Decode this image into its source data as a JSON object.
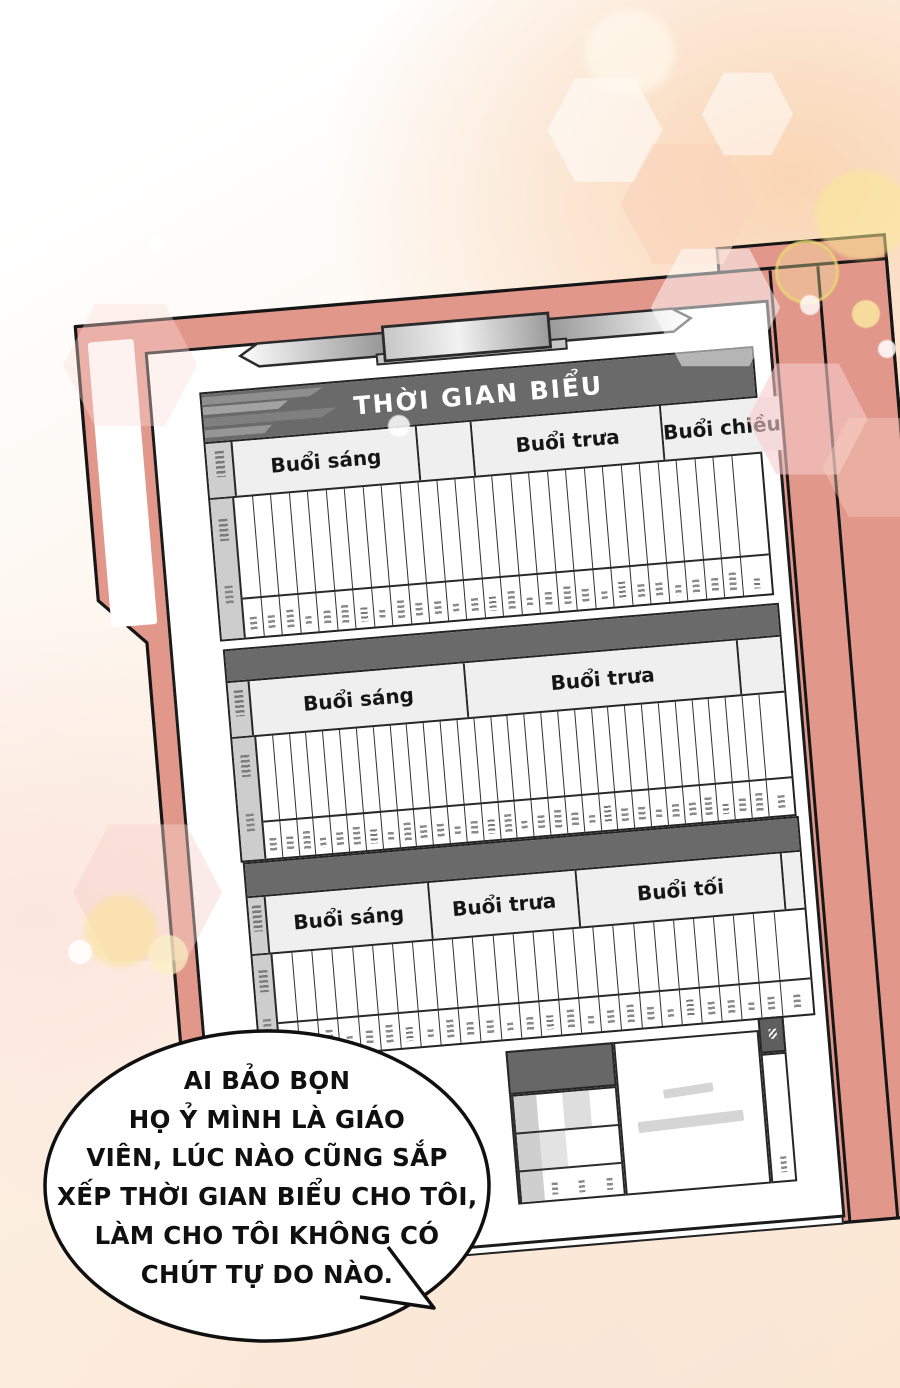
{
  "comic": {
    "paper": {
      "title": "THỜI GIAN BIỂU",
      "tables": [
        {
          "sessions": [
            "Buổi sáng",
            "Buổi trưa",
            "Buổi chiều"
          ],
          "column_count": 28
        },
        {
          "sessions": [
            "Buổi sáng",
            "Buổi trưa"
          ],
          "column_count": 31
        },
        {
          "sessions": [
            "Buổi sáng",
            "Buổi trưa",
            "Buổi tối"
          ],
          "column_count": 26
        }
      ]
    },
    "speech_bubble": {
      "lines": [
        "AI BẢO BỌN",
        "HỌ Ỷ MÌNH LÀ GIÁO",
        "VIÊN, LÚC NÀO CŨNG SẮP",
        "XẾP THỜI GIAN BIỂU CHO TÔI,",
        "LÀM CHO TÔI KHÔNG CÓ",
        "CHÚT TỰ DO NÀO."
      ]
    },
    "colors": {
      "folder": "#e2978b",
      "band": "#6a6a6a",
      "paper": "#ffffff",
      "outline": "#1b1b1b",
      "header_bg": "#efefef"
    }
  }
}
